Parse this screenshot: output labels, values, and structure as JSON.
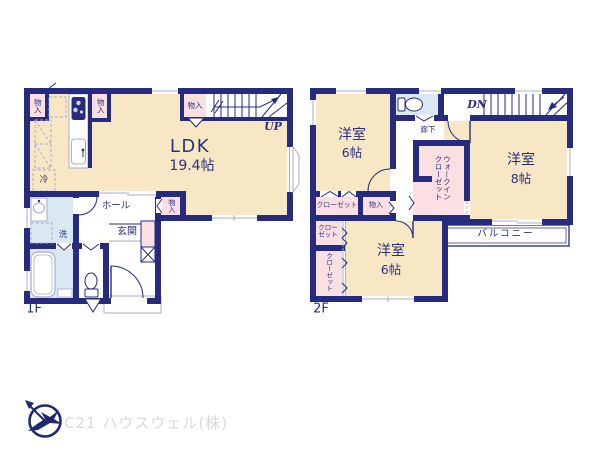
{
  "colors": {
    "wall_navy": "#272b7d",
    "room_cream": "#f7e7c4",
    "closet_pink": "#fbdfe2",
    "wet_blue": "#d9e8f3",
    "fixture_gray": "#a8aec8",
    "label_navy": "#2b3080",
    "logo_navy": "#1f2a72",
    "footer_gray": "#d9d9d9"
  },
  "f1": {
    "floor_label": "1F",
    "ldk_name": "LDK",
    "ldk_size": "19.4帖",
    "hall": "ホール",
    "entrance": "玄関",
    "wash": "洗",
    "fridge": "冷",
    "stairs_up": "UP",
    "storage_tl": "物入",
    "storage_kitchen": "物入",
    "storage_stairs": "物入",
    "storage_hall": "物入"
  },
  "f2": {
    "floor_label": "2F",
    "room_nw_name": "洋室",
    "room_nw_size": "6帖",
    "room_e_name": "洋室",
    "room_e_size": "8帖",
    "room_s_name": "洋室",
    "room_s_size": "6帖",
    "corridor": "廊下",
    "stairs_down": "DN",
    "wic_col1": "ウォークイン",
    "wic_col2": "クローゼット",
    "closet_nw": "クローゼット",
    "storage": "物入",
    "closet_w1_line1": "クロー",
    "closet_w1_line2": "ゼット",
    "closet_w2": "クローゼット",
    "balcony": "バルコニー"
  },
  "footer": {
    "company": "C21 ハウスウェル(株)"
  }
}
